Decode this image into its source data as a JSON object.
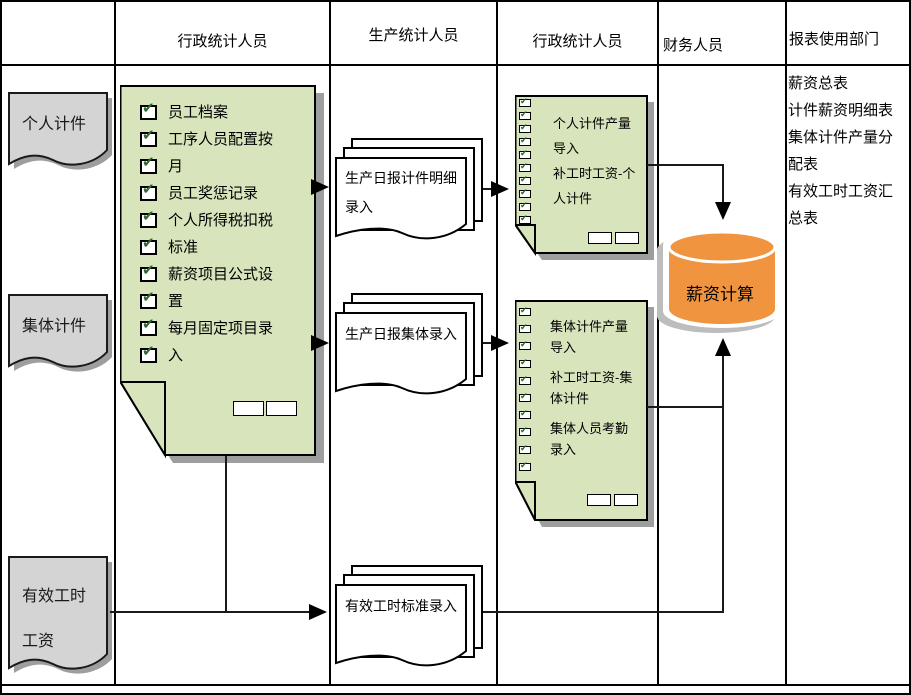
{
  "header": {
    "cols": [
      "",
      "行政统计人员",
      "生产统计人员",
      "行政统计人员",
      "财务人员",
      "报表使用部门"
    ]
  },
  "left_docs": {
    "personal": "个人计件",
    "group": "集体计件",
    "valid_hours": "有效工时工资"
  },
  "admin_note": {
    "items": [
      "员工档案",
      "工序人员配置按月",
      "员工奖惩记录",
      "个人所得税扣税标准",
      "薪资项目公式设置",
      "每月固定项目录入"
    ]
  },
  "production_docs": {
    "piecework": "生产日报计件明细录入",
    "group": "生产日报集体录入",
    "hours": "有效工时标准录入"
  },
  "import_note_personal": {
    "items": [
      "个人计件产量导入",
      "补工时工资-个人计件"
    ]
  },
  "import_note_group": {
    "items": [
      "集体计件产量导入",
      "补工时工资-集体计件",
      "集体人员考勤录入"
    ]
  },
  "database": {
    "label": "薪资计算"
  },
  "reports": {
    "items": [
      "薪资总表",
      "计件薪资明细表",
      "集体计件产量分配表",
      "有效工时工资汇总表"
    ]
  },
  "colors": {
    "note_fill": "#d7e4bc",
    "doc_fill": "#d4d4d4",
    "cylinder_fill": "#f0943f",
    "cylinder_ring": "#ffffff",
    "shadow": "#9e9e9e",
    "check": "#336633",
    "line": "#000000"
  }
}
